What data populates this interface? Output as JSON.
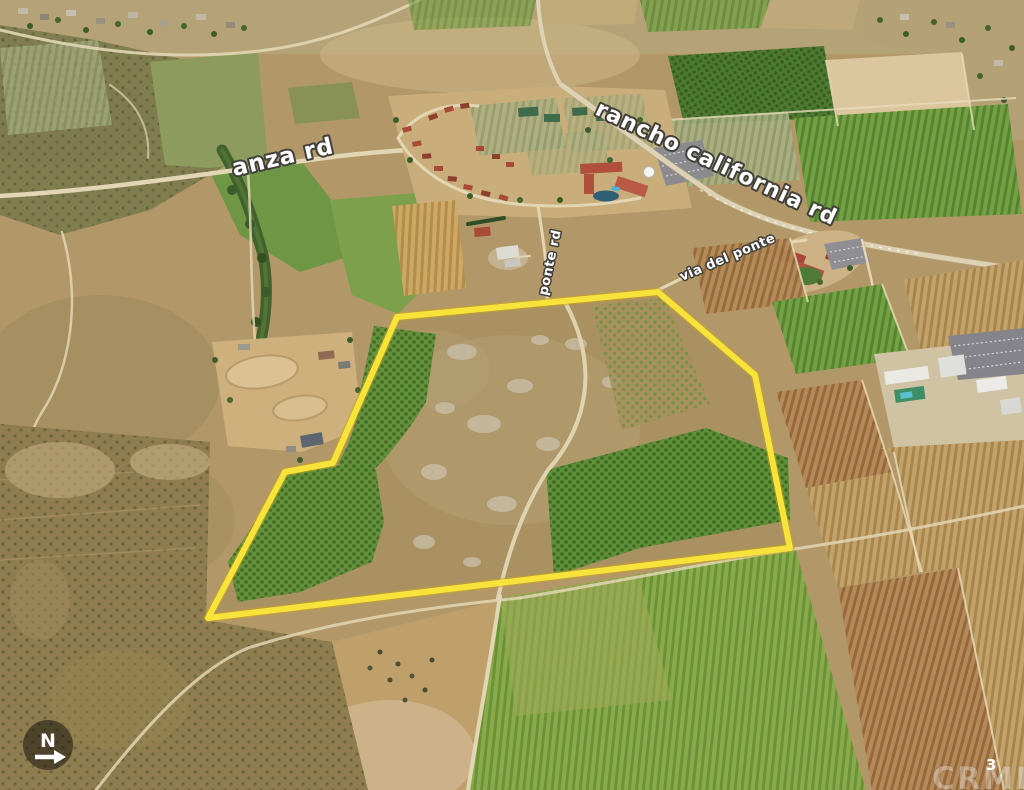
{
  "road_labels": {
    "anza": "anza rd",
    "rancho_california": "rancho california rd",
    "ponte": "ponte rd",
    "via_del_ponte": "via del ponte"
  },
  "compass": {
    "letter": "N",
    "arrow_direction": "right"
  },
  "watermark": {
    "brand": "CRMLS",
    "page_number": "3"
  },
  "colors": {
    "parcel_outline": "#f8e33a",
    "label_text": "#ffffff",
    "label_outline": "#42403a",
    "compass_background": "rgba(25,20,12,0.55)"
  }
}
